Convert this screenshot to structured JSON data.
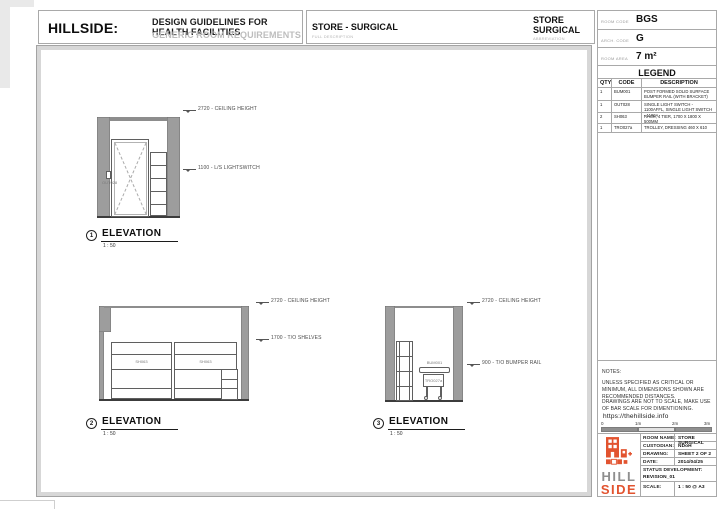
{
  "header": {
    "brand": "HILLSIDE:",
    "title": "DESIGN GUIDELINES FOR HEALTH FACILITIES",
    "subtitle": "GENERIC ROOM REQUIREMENTS",
    "full_name": "STORE - SURGICAL",
    "full_caption": "FULL DESCRIPTION",
    "abbr_line1": "STORE",
    "abbr_line2": "SURGICAL",
    "abbr_caption": "ABBREVIATION"
  },
  "room_info": {
    "rows": [
      {
        "label": "ROOM CODE",
        "value": "BGS"
      },
      {
        "label": "ARCH. CODE",
        "value": "G"
      },
      {
        "label": "ROOM AREA",
        "value": "7 m²"
      }
    ]
  },
  "legend": {
    "title": "LEGEND",
    "col_qty": "QTY",
    "col_code": "CODE",
    "col_desc": "DESCRIPTION",
    "rows": [
      {
        "qty": "1",
        "code": "BUM001",
        "desc": "POST FORMED SOLID SURFACE BUMPER RAIL (WITH BRACKET)"
      },
      {
        "qty": "1",
        "code": "OUT028",
        "desc": "SINGLE LIGHT SWITCH - 1100AFFL, SINGLE LIGHT SWITCH - 1100A"
      },
      {
        "qty": "2",
        "code": "SH063",
        "desc": "RACK, 4 TIER, 1700 X 1800 X 500MM"
      },
      {
        "qty": "1",
        "code": "TRO027a",
        "desc": "TROLLEY, DRESSING 460 X 610"
      }
    ]
  },
  "elevations": [
    {
      "num": "1",
      "title": "ELEVATION",
      "scale": "1 : 50",
      "ann_ceiling": "2720 - CEILING HEIGHT",
      "ann_mid": "1100 - L/S LIGHTSWITCH",
      "switch_label": "OUT028"
    },
    {
      "num": "2",
      "title": "ELEVATION",
      "scale": "1 : 50",
      "ann_ceiling": "2720 - CEILING HEIGHT",
      "ann_mid": "1700 - T/O SHELVES",
      "rack_label_a": "SH063",
      "rack_label_b": "SH063"
    },
    {
      "num": "3",
      "title": "ELEVATION",
      "scale": "1 : 50",
      "ann_ceiling": "2720 - CEILING HEIGHT",
      "ann_mid": "900 - T/O BUMPER RAIL",
      "rail_label": "BUM001",
      "trolley_label": "TRO027a"
    }
  ],
  "notes": {
    "heading": "NOTES:",
    "line1": "UNLESS SPECIFIED AS CRITICAL OR MINIMUM, ALL DIMENSIONS SHOWN ARE RECOMMENDED DISTANCES.",
    "line2": "DRAWINGS ARE NOT TO SCALE, MAKE USE OF BAR SCALE FOR DIMENTIONING.",
    "url": "https://thehillside.info"
  },
  "bar_scale": {
    "ticks": [
      "0",
      "1m",
      "2m",
      "3m"
    ]
  },
  "title_block": {
    "logo_top": "HILL",
    "logo_bottom": "SIDE",
    "rows": [
      {
        "label": "ROOM NAME:",
        "value": "STORE SURGICAL"
      },
      {
        "label": "CUSTODIAN:",
        "value": "NDoH"
      },
      {
        "label": "DRAWING:",
        "value": "SHEET 2 OF 2"
      },
      {
        "label": "DATE:",
        "value": "2014/04/25"
      }
    ],
    "status_label": "STATUS DEVELOPMENT:",
    "status_value": "REVISION_01",
    "scale_label": "SCALE:",
    "scale_value": "1 : 50 @ A3"
  },
  "colors": {
    "accent": "#E2532F",
    "wall_gray": "#9D9D9D",
    "frame_gray": "#D7D7D7"
  }
}
